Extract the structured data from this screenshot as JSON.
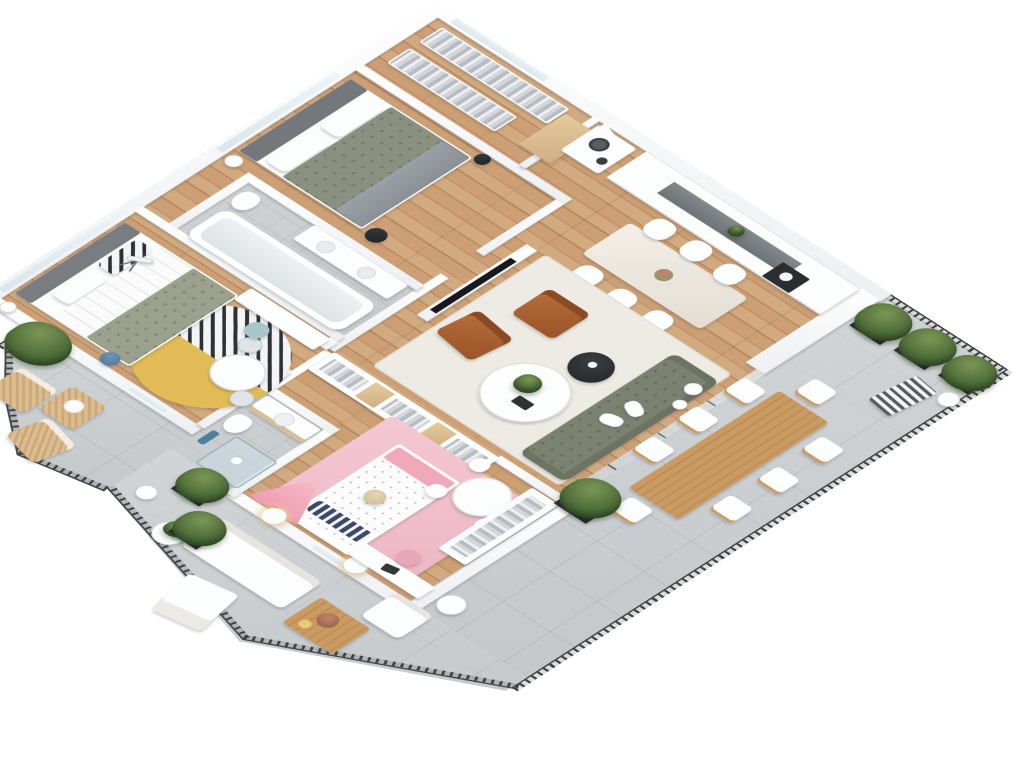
{
  "scene": {
    "description": "3D isometric floor plan rendering of a furnished apartment with wrap-around terrace and corner balcony",
    "background_color": "#ffffff"
  },
  "palette": {
    "wood_floor": "#c89a6e",
    "tile_floor": "#cdd0d2",
    "walls": "#f8f9fa",
    "railing": "#3f4245",
    "sofa_green": "#7c8271",
    "armchair_cognac": "#b06a3b",
    "kids_pink": "#f1c3ce",
    "rug_yellow": "#e2bb56",
    "plant_green": "#4c6a38",
    "bed_green": "#8b9180",
    "accent_blue": "#5b86a5"
  },
  "rooms": {
    "walk_in_closet": {
      "label": "Walk-in closet",
      "furniture": [
        "clothes rack",
        "second clothes rack",
        "wood shelving",
        "washer-dryer stack"
      ]
    },
    "master_bedroom": {
      "label": "Master bedroom",
      "furniture": [
        "double bed with green duvet",
        "white pillows",
        "gray headboard",
        "dark nightstand with lamp",
        "black stool",
        "floor lamp"
      ]
    },
    "kitchen": {
      "label": "Kitchen",
      "furniture": [
        "white cabinet run",
        "dark counter niche",
        "oven",
        "counter plant"
      ]
    },
    "dining_area": {
      "label": "Dining area",
      "furniture": [
        "dining table",
        "white chair",
        "flower vase"
      ]
    },
    "living_room": {
      "label": "Living room",
      "furniture": [
        "TV media wall",
        "green tufted sofa",
        "cognac armchair",
        "second cognac armchair",
        "round coffee table",
        "black side table",
        "white rug",
        "floor vases",
        "open wardrobe row"
      ]
    },
    "bathroom_1": {
      "label": "Main bathroom",
      "furniture": [
        "bathtub",
        "vanity with sinks",
        "toilet"
      ]
    },
    "bathroom_2": {
      "label": "Shower bathroom",
      "furniture": [
        "shower cabin",
        "vanity sink",
        "toilet",
        "blue towel"
      ]
    },
    "bedroom_2": {
      "label": "Second bedroom",
      "furniture": [
        "bed with green striped duvet",
        "patterned pillow",
        "round two-tone rug",
        "round side table",
        "small chairs",
        "desk with blue chair",
        "telescope",
        "floor lamp",
        "blue basket"
      ]
    },
    "kids_bedroom": {
      "label": "Kids bedroom",
      "furniture": [
        "polka-dot bed",
        "navy striped pillow",
        "pink teepee tent",
        "pink rug",
        "nightstand lamp",
        "second nightstand lamp",
        "desk with pink chair",
        "kids round table",
        "kids chair",
        "wardrobe with hanging clothes",
        "teddy bear"
      ]
    },
    "hallway": {
      "label": "Hallway and entry",
      "furniture": [
        "entry door"
      ]
    }
  },
  "outdoor": {
    "terrace": {
      "label": "Wrap-around terrace",
      "furniture": [
        "wooden outdoor dining table",
        "outdoor chair",
        "planter box with shrub",
        "white planter vase",
        "striped deck lounger",
        "outdoor sofa",
        "outdoor armchair",
        "sun lounger",
        "wooden coffee table with tray",
        "side table with plant",
        "round side table",
        "white ball lamp",
        "potted tree"
      ]
    },
    "balcony": {
      "label": "Corner balcony",
      "furniture": [
        "rattan armchair",
        "second rattan armchair",
        "rattan coffee table",
        "large potted plant",
        "white ball lamp"
      ]
    },
    "railing": {
      "label": "Black metal railing"
    }
  }
}
